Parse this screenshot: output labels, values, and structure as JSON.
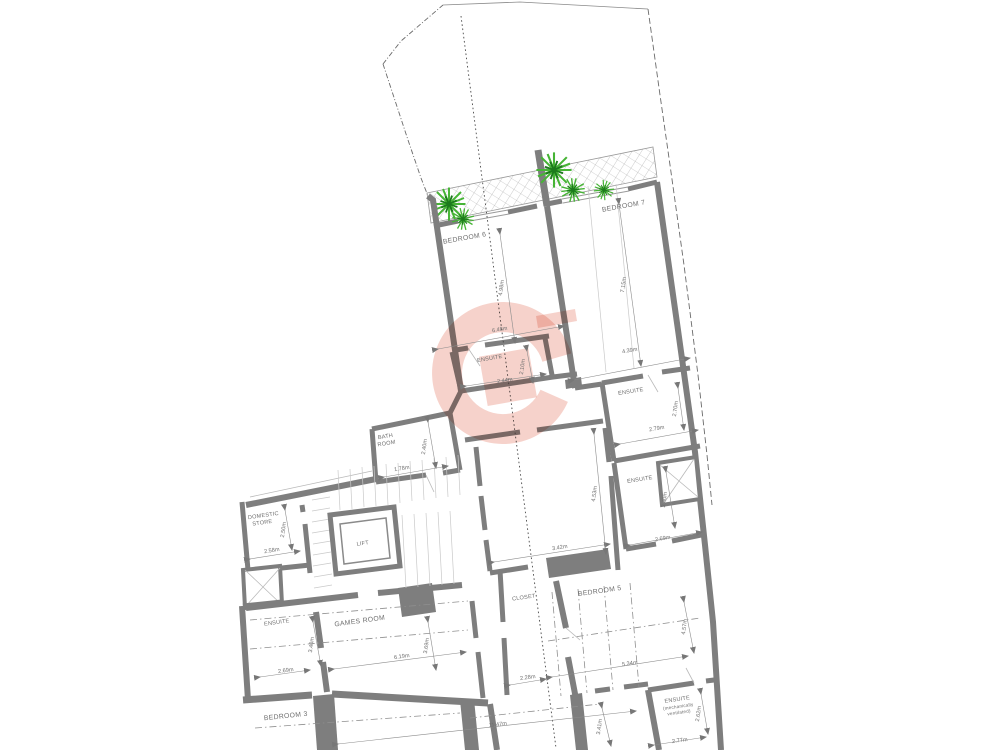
{
  "plan": {
    "kind": "architectural floor plan",
    "rooms": {
      "bedroom6": {
        "label": "BEDROOM 6",
        "width": "6.48m",
        "height": "4.98m"
      },
      "bedroom7": {
        "label": "BEDROOM 7",
        "width": "4.39m",
        "height": "7.15m"
      },
      "ensuite6": {
        "label": "ENSUITE",
        "width": "2.44m",
        "height": "2.10m"
      },
      "ensuite7": {
        "label": "ENSUITE",
        "width": "2.79m",
        "height": "2.70m"
      },
      "ensuite_mid": {
        "label": "ENSUITE",
        "width": "2.69m",
        "height": "3.40m"
      },
      "bathroom": {
        "label_line1": "BATH",
        "label_line2": "ROOM",
        "width": "1.78m",
        "height": "2.40m"
      },
      "domestic_store": {
        "label_line1": "DOMESTIC",
        "label_line2": "STORE",
        "width": "2.58m",
        "height": "2.50m"
      },
      "lift": {
        "label": "LIFT"
      },
      "landing_void": {
        "width": "3.42m",
        "height": "4.53m"
      },
      "ensuite_lower": {
        "label": "ENSUITE",
        "width": "2.69m",
        "height": "3.40m"
      },
      "games_room": {
        "label": "GAMES ROOM",
        "width": "6.19m",
        "height": "3.69m"
      },
      "bedroom3": {
        "label": "BEDROOM 3"
      },
      "closet": {
        "label": "CLOSET",
        "width": "2.28m"
      },
      "bedroom5": {
        "label": "BEDROOM 5",
        "width": "5.34m",
        "height": "4.57m"
      },
      "ensuite_mv": {
        "label_line1": "ENSUITE",
        "label_line2": "(mechanically",
        "label_line3": "ventilated)",
        "width": "2.77m",
        "height": "2.62m"
      },
      "lower_hall": {
        "width": "11.47m",
        "height": "3.41m"
      }
    },
    "colors": {
      "wall": "#7e7e7e",
      "watermark": "#e98f7d",
      "plant_light": "#46b435",
      "plant_dark": "#1c7a1c"
    }
  }
}
